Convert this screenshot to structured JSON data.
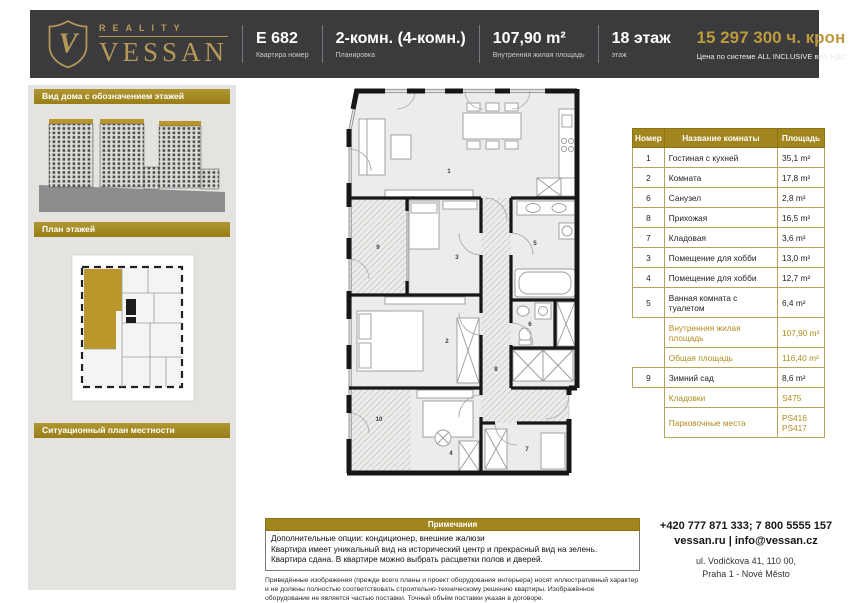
{
  "header": {
    "brand": {
      "monogram": "V",
      "reality": "REALITY",
      "name": "VESSAN"
    },
    "fields": [
      {
        "value": "E 682",
        "label": "Квартира номер"
      },
      {
        "value": "2-комн. (4-комн.)",
        "label": "Планировка"
      },
      {
        "value": "107,90 m²",
        "label": "Внутренняя жилая площадь"
      },
      {
        "value": "18 этаж",
        "label": "этаж"
      }
    ],
    "price": {
      "value": "15 297 300 ч. крон",
      "label": "Цена по системе ALL INCLUSIVE вкл. НДС"
    }
  },
  "sidebar": {
    "section_house": "Вид дома с обозначением этажей",
    "section_floorplan": "План этажей",
    "section_map": "Ситуационный план местности"
  },
  "floorplan": {
    "labels": {
      "r1": "1",
      "r2": "2",
      "r3": "3",
      "r4": "4",
      "r5": "5",
      "r6": "6",
      "r7": "7",
      "r8": "8",
      "r9": "9",
      "r10": "10"
    }
  },
  "room_table": {
    "headers": [
      "Номер",
      "Название комнаты",
      "Площадь"
    ],
    "rows": [
      {
        "num": "1",
        "name": "Гостиная с кухней",
        "area": "35,1 m²"
      },
      {
        "num": "2",
        "name": "Комната",
        "area": "17,8 m²"
      },
      {
        "num": "6",
        "name": "Санузел",
        "area": "2,8 m²"
      },
      {
        "num": "8",
        "name": "Прихожая",
        "area": "16,5 m²"
      },
      {
        "num": "7",
        "name": "Кладовая",
        "area": "3,6 m²"
      },
      {
        "num": "3",
        "name": "Помещение для хобби",
        "area": "13,0 m²"
      },
      {
        "num": "4",
        "name": "Помещение для хобби",
        "area": "12,7 m²"
      },
      {
        "num": "5",
        "name": "Ванная комната с туалетом",
        "area": "6,4 m²"
      },
      {
        "num": "",
        "name": "Внутренняя жилая площадь",
        "area": "107,90 m²"
      },
      {
        "num": "",
        "name": "Общая площадь",
        "area": "116,40 m²"
      },
      {
        "num": "9",
        "name": "Зимний сад",
        "area": "8,6 m²"
      },
      {
        "num": "",
        "name": "Кладовки",
        "area": "S475"
      },
      {
        "num": "",
        "name": "Парковочные места",
        "area": "PS416\nPS417"
      }
    ]
  },
  "notes": {
    "title": "Примечания",
    "lines": [
      "Дополнительные опции: кондиционер, внешние жалюзи",
      "Квартира имеет уникальный вид на исторический центр и прекрасный вид на зелень.",
      "Квартира сдана. В квартире можно выбрать расцветки полов и дверей."
    ],
    "disclaimer": "Приведённые изображения (прежде всего планы и проект оборудования интерьера) носят иллюстративный характер и не должны полностью соответствовать строительно-техническому решению квартиры. Изображённое оборудование не является частью поставки. Точный объём поставки указан в договоре."
  },
  "contact": {
    "phones": "+420 777 871 333; 7 800 5555 157",
    "web": "vessan.ru | info@vessan.cz",
    "address_line1": "ul. Vodičkova 41, 110 00,",
    "address_line2": "Praha 1 - Nové Město"
  },
  "colors": {
    "header_bg": "#3b3b3d",
    "brand_gold": "#b69957",
    "price_gold": "#bd9b3d",
    "bar_gold": "#a1861d",
    "table_gold_text": "#b08c1e",
    "sidebar_bg": "#e4e3df",
    "highlight_unit": "#bb962b"
  }
}
